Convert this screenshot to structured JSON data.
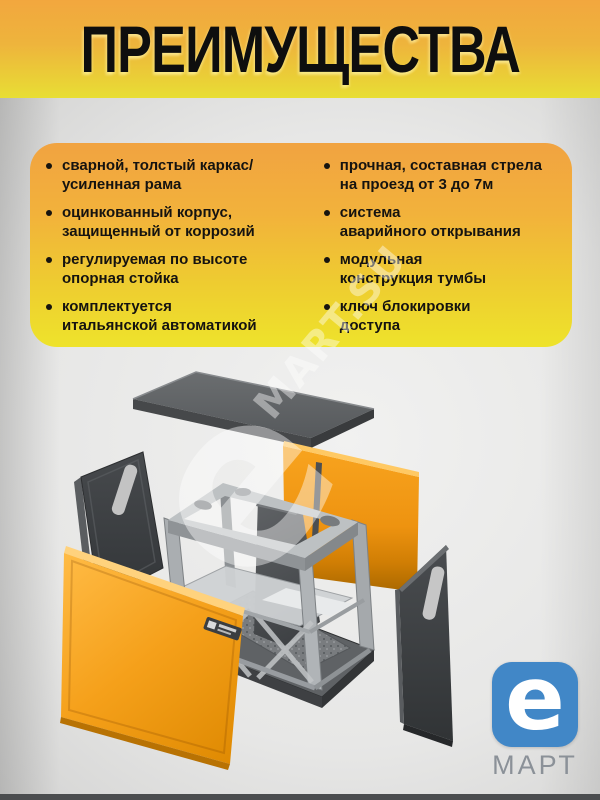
{
  "title": "ПРЕИМУЩЕСТВА",
  "advantages": {
    "left": [
      "сварной, толстый каркас/\nусиленная рама",
      "оцинкованный корпус,\nзащищенный от коррозий",
      "регулируемая по высоте\nопорная стойка",
      "комплектуется\nитальянской автоматикой"
    ],
    "right": [
      "прочная, составная стрела\nна проезд от 3 до 7м",
      "система\nаварийного открывания",
      "модульная\nконструкция тумбы",
      "ключ блокировки\nдоступа"
    ]
  },
  "watermark": {
    "prefix": "e",
    "text": "MART.SU"
  },
  "logo": {
    "symbol": "e",
    "brand": "МАРТ"
  },
  "illustration": {
    "description": "Exploded 3D view of a modular barrier cabinet (tumba): gray top lid, orange front and rear panels, dark gray side panels, steel frame with drive unit on a base plate"
  },
  "colors": {
    "banner_top": "#f2a73e",
    "banner_bottom": "#e8de34",
    "card_top": "#f1a341",
    "card_bottom": "#eee32b",
    "orange_panel": "#f5a01a",
    "orange_deep": "#a96800",
    "lid_gray": "#5b5e60",
    "dark_panel": "#3c3f42",
    "steel_gray": "#bcc0c2",
    "logo_blue": "#4187c7",
    "brand_gray": "#8b9198",
    "title_text": "#0e0e0e"
  }
}
